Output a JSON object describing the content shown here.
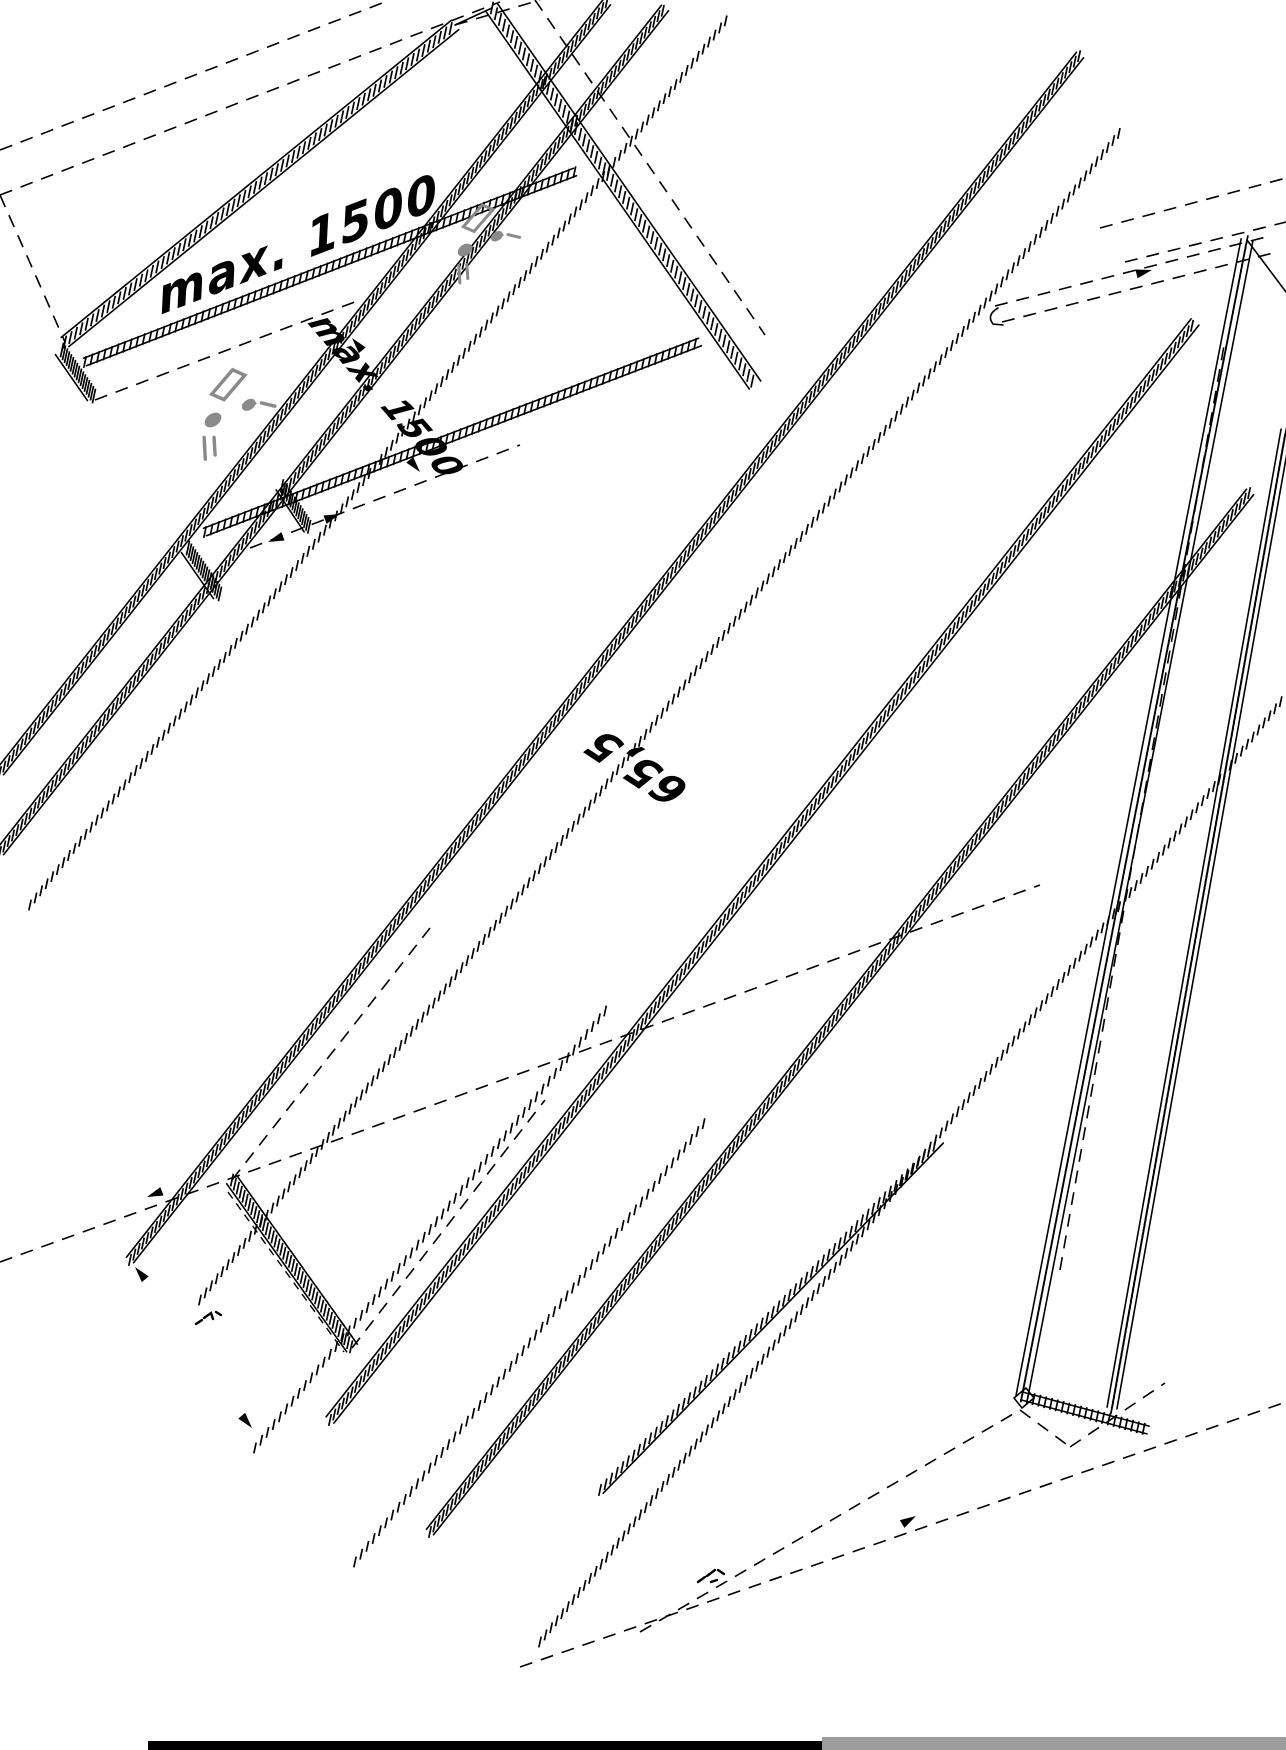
{
  "diagram": {
    "title": "wardrobe-assembly-isometric-drawing",
    "labels": {
      "dim_top": "max. 1500",
      "dim_mid": "max. 1500",
      "dim_center": "65,5"
    },
    "colors": {
      "line": "#000000",
      "fitting_gray": "#8a8a8a",
      "scan_bar_black": "#000000",
      "scan_bar_gray": "#9c9c9c",
      "background": "#ffffff"
    }
  }
}
